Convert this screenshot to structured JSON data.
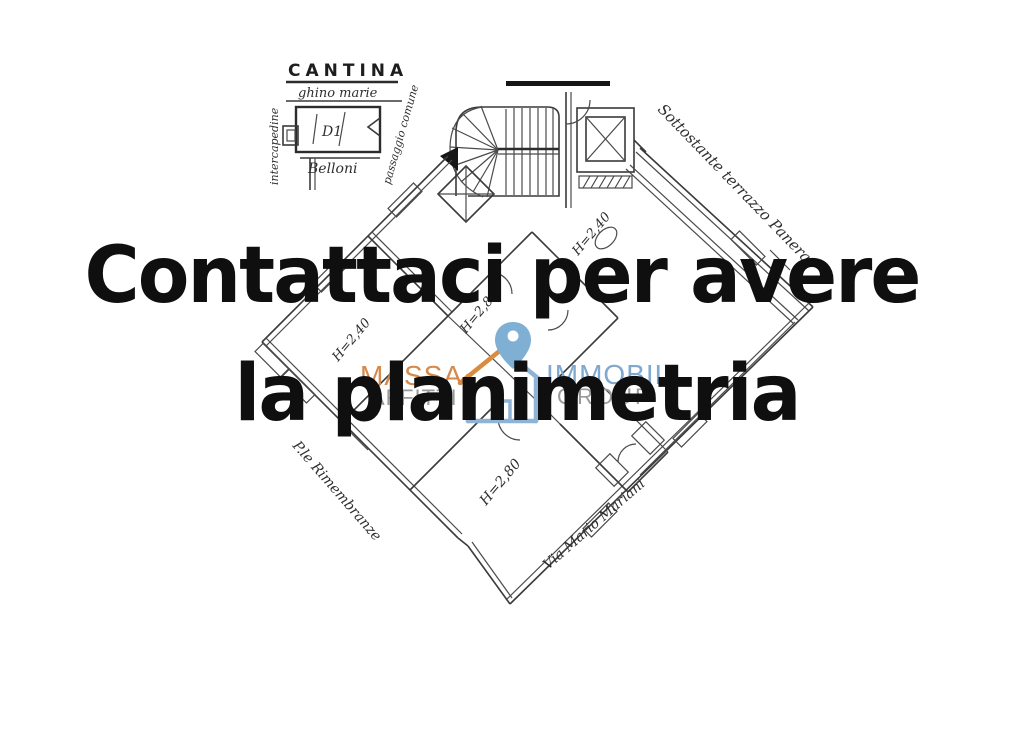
{
  "overlay": {
    "line1": "Contattaci per avere",
    "line2": "la planimetria",
    "color": "#0f0f0f"
  },
  "watermark": {
    "massa": "MASSA",
    "affitti": "AFFITTI",
    "immobil": "IMMOBIL",
    "group": "GROUP",
    "colors": {
      "massa_orange": "#D5894B",
      "immobil_blue": "#7FA9CE",
      "gray": "#9A9A9A",
      "pin_blue": "#7FB0D4",
      "house_orange": "#D98C3F",
      "house_blue": "#8FB3D4"
    }
  },
  "plan": {
    "cantina": {
      "title": "CANTINA",
      "subtitle": "ghino marie",
      "room_code": "D1",
      "below_label": "Belloni",
      "left_label": "intercapedine",
      "right_label": "passaggio comune"
    },
    "street_labels": {
      "top_right": "Sottostante terrazzo Panerai",
      "bottom_left": "P.le Rimembranze",
      "bottom_right": "Via Mario Mariani"
    },
    "height_labels": [
      "H=2,40",
      "H=2,40",
      "H=2,80",
      "H=2,80"
    ]
  }
}
